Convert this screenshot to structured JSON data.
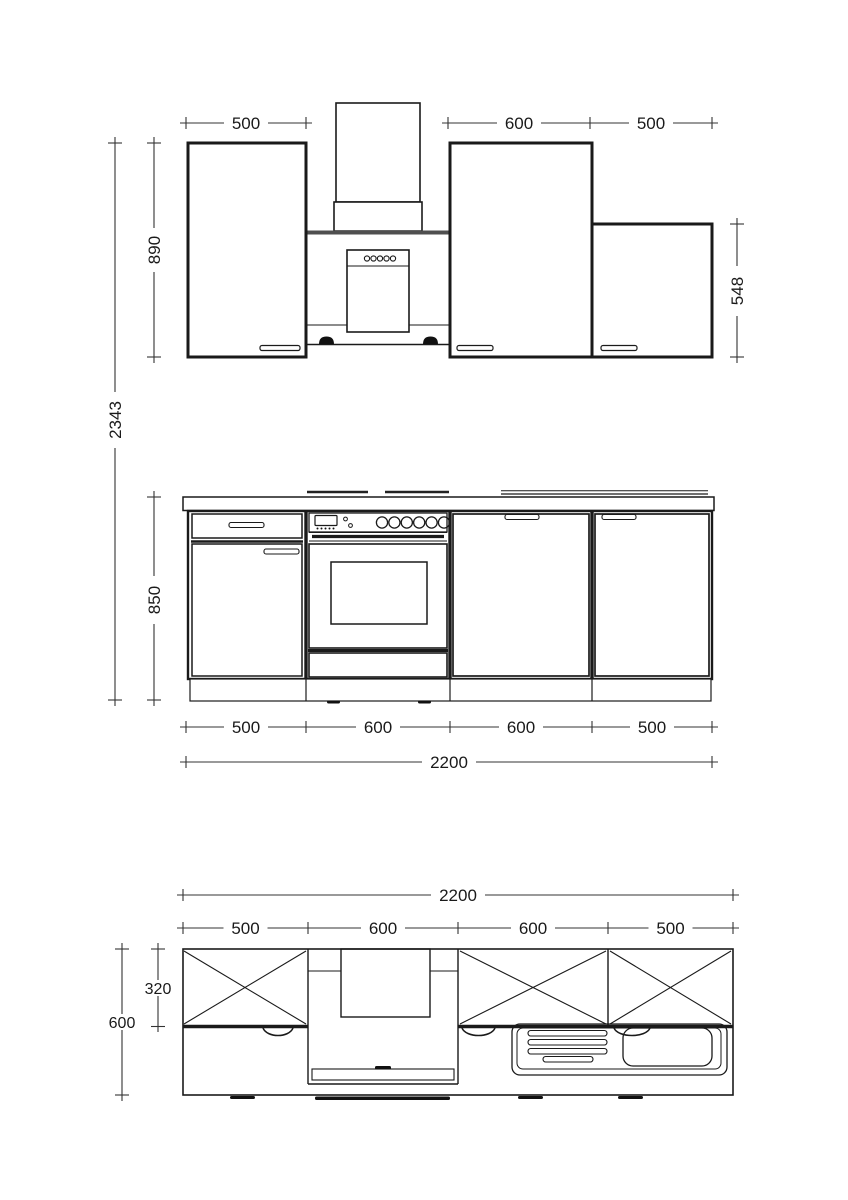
{
  "figure": {
    "type": "kitchen-cabinet-technical-drawing",
    "views": [
      "upper elevation",
      "base elevation",
      "plan view"
    ]
  },
  "colors": {
    "line": "#1a1a1a",
    "dimension": "#333333",
    "hood_bar": "#4f4f4f",
    "background": "#ffffff"
  },
  "upper_elevation": {
    "dim_width_left": "500",
    "dim_width_mid": "600",
    "dim_width_right": "500",
    "dim_height_wall_cabinets": "890",
    "dim_height_short_cabinet": "548",
    "dim_height_total": "2343"
  },
  "base_elevation": {
    "dim_height": "850",
    "dim_w1": "500",
    "dim_w2": "600",
    "dim_w3": "600",
    "dim_w4": "500",
    "dim_total_width": "2200"
  },
  "plan_view": {
    "dim_total_width": "2200",
    "dim_w1": "500",
    "dim_w2": "600",
    "dim_w3": "600",
    "dim_w4": "500",
    "dim_depth": "600",
    "dim_wall_cabinet_depth": "320"
  }
}
